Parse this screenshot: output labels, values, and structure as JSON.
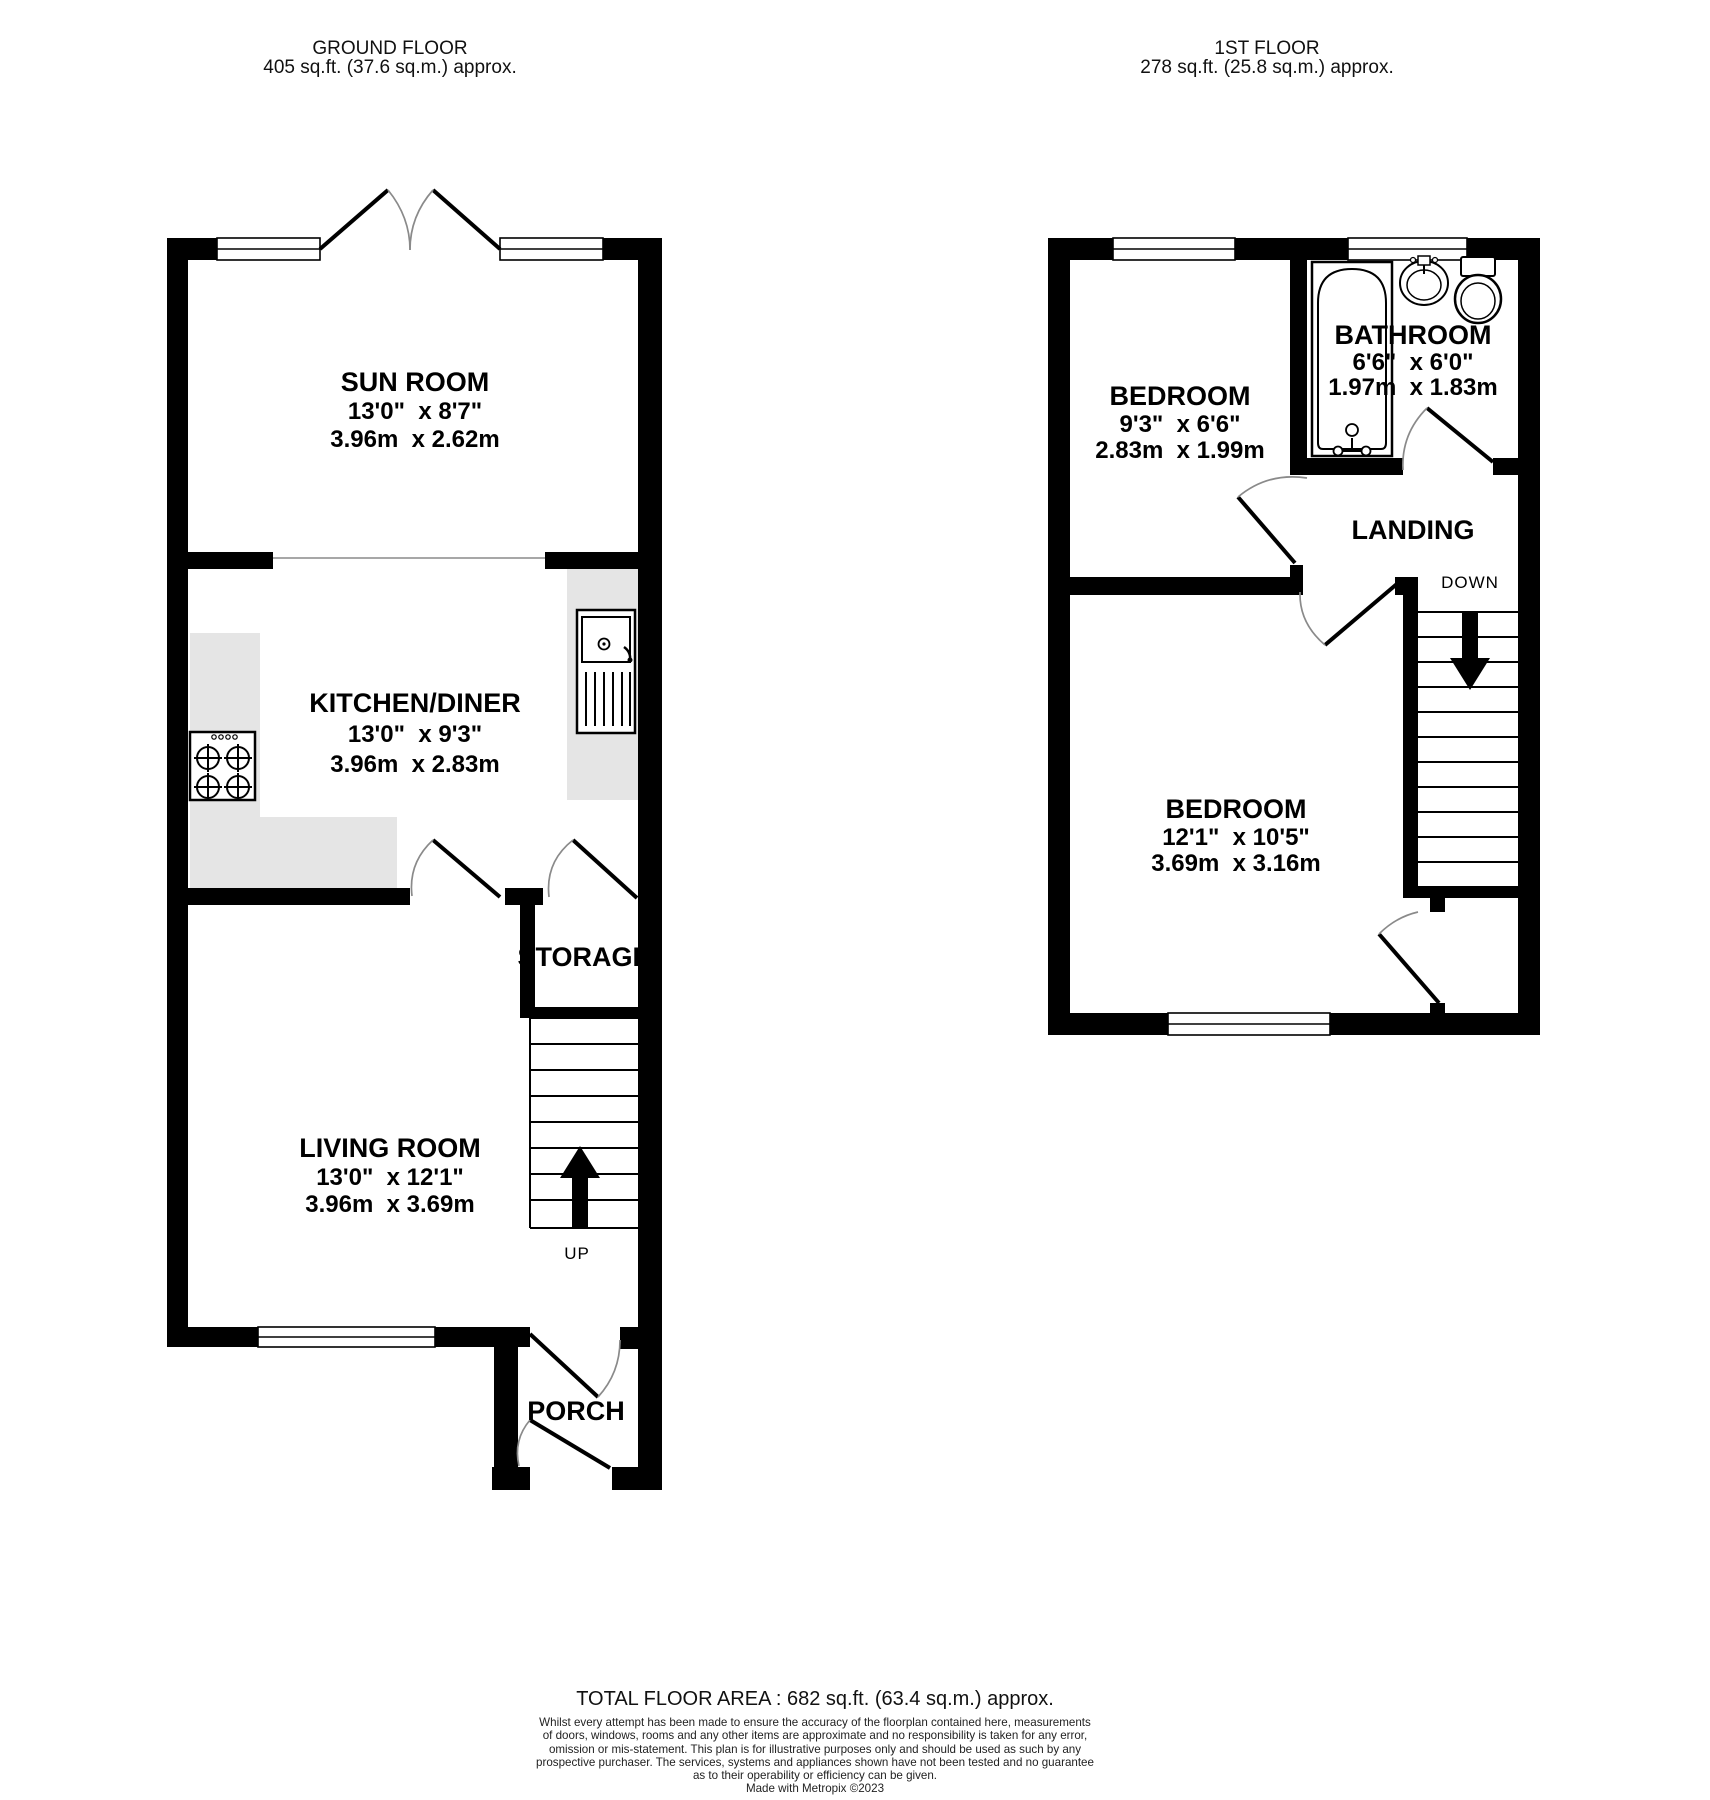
{
  "ground_floor": {
    "header_line1": "GROUND FLOOR",
    "header_line2": "405 sq.ft. (37.6 sq.m.) approx.",
    "rooms": {
      "sun_room": {
        "name": "SUN ROOM",
        "imperial": "13'0\"  x 8'7\"",
        "metric": "3.96m  x 2.62m"
      },
      "kitchen": {
        "name": "KITCHEN/DINER",
        "imperial": "13'0\"  x 9'3\"",
        "metric": "3.96m  x 2.83m"
      },
      "living_room": {
        "name": "LIVING ROOM",
        "imperial": "13'0\"  x 12'1\"",
        "metric": "3.96m  x 3.69m"
      },
      "storage": {
        "name": "STORAGE"
      },
      "porch": {
        "name": "PORCH"
      }
    },
    "stairs_label": "UP",
    "fixtures": [
      "hob-icon",
      "kitchen-sink-icon"
    ]
  },
  "first_floor": {
    "header_line1": "1ST FLOOR",
    "header_line2": "278 sq.ft. (25.8 sq.m.) approx.",
    "rooms": {
      "bedroom_1": {
        "name": "BEDROOM",
        "imperial": "9'3\"  x 6'6\"",
        "metric": "2.83m  x 1.99m"
      },
      "bathroom": {
        "name": "BATHROOM",
        "imperial": "6'6\"  x 6'0\"",
        "metric": "1.97m  x 1.83m"
      },
      "landing": {
        "name": "LANDING"
      },
      "bedroom_2": {
        "name": "BEDROOM",
        "imperial": "12'1\"  x 10'5\"",
        "metric": "3.69m  x 3.16m"
      }
    },
    "stairs_label": "DOWN",
    "fixtures": [
      "bathtub-icon",
      "basin-icon",
      "toilet-icon"
    ]
  },
  "footer": {
    "total_area": "TOTAL FLOOR AREA : 682 sq.ft. (63.4 sq.m.) approx.",
    "disclaimer_lines": [
      "Whilst every attempt has been made to ensure the accuracy of the floorplan contained here, measurements",
      "of doors, windows, rooms and any other items are approximate and no responsibility is taken for any error,",
      "omission or mis-statement. This plan is for illustrative purposes only and should be used as such by any",
      "prospective purchaser. The services, systems and appliances shown have not been tested and no guarantee",
      "as to their operability or efficiency can be given."
    ],
    "credit": "Made with Metropix ©2023"
  },
  "colors": {
    "wall": "#000000",
    "counter": "#e5e5e5",
    "door_swing": "#8a8a8a",
    "background": "#ffffff"
  }
}
